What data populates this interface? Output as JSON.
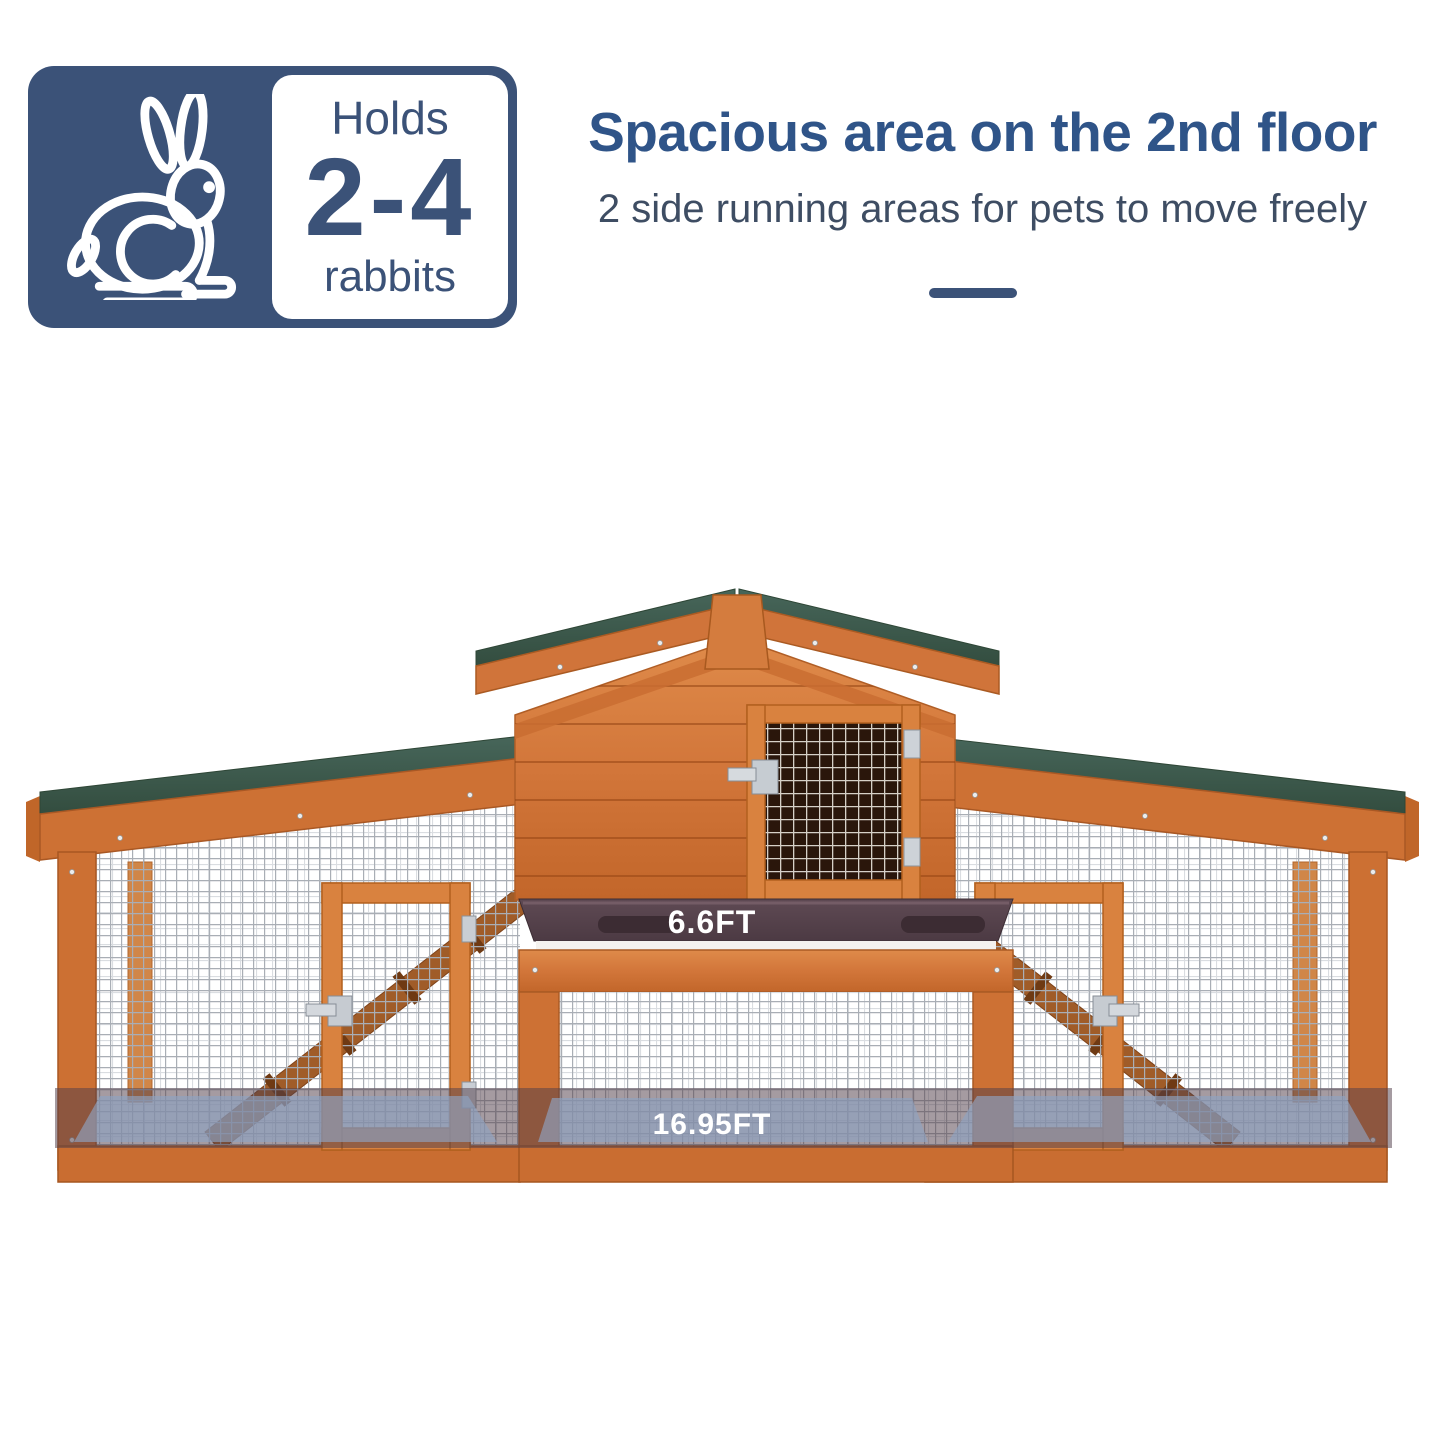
{
  "badge": {
    "icon": "rabbit-icon",
    "holds_label": "Holds",
    "capacity": "2-4",
    "animal_label": "rabbits"
  },
  "header": {
    "title": "Spacious area on the 2nd floor",
    "subtitle": "2 side running areas for pets to move freely"
  },
  "product": {
    "subject": "wooden rabbit hutch with center house and two side running areas",
    "dimension_labels": {
      "upper_width": "6.6FT",
      "total_width": "16.95FT"
    },
    "colors": {
      "accent_navy": "#3b5278",
      "title_blue": "#2f5488",
      "wood_orange": "#d0743a",
      "roof_green": "#3e5b48",
      "tray_brown": "#55414b",
      "overlay_band": "#52404a",
      "overlay_floor_blue": "#8fa2c1",
      "mesh_gray": "#a9aeb5"
    }
  }
}
